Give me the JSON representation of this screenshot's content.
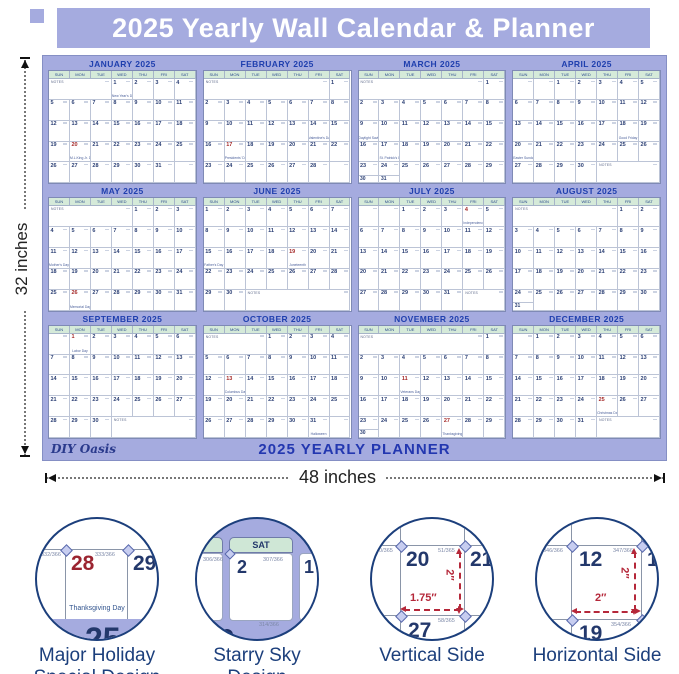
{
  "header": {
    "title": "2025 Yearly Wall Calendar & Planner"
  },
  "dimensions": {
    "height_label": "32 inches",
    "width_label": "48 inches"
  },
  "poster": {
    "brand": "DIY Oasis",
    "footer_title": "2025 YEARLY PLANNER",
    "notes_label": "NOTES",
    "day_headers": [
      "SUN",
      "MON",
      "TUE",
      "WED",
      "THU",
      "FRI",
      "SAT"
    ],
    "months": [
      {
        "title": "JANUARY 2025",
        "first_dow": 3,
        "days": 31,
        "red_days": [
          20
        ],
        "holidays": {
          "1": "New Year's Day",
          "20": "M.L.King Jr. Day"
        },
        "notes": "lead"
      },
      {
        "title": "FEBRUARY 2025",
        "first_dow": 6,
        "days": 28,
        "red_days": [
          17
        ],
        "holidays": {
          "14": "Valentine's Day",
          "17": "Presidents' Day"
        },
        "notes": "lead"
      },
      {
        "title": "MARCH 2025",
        "first_dow": 6,
        "days": 31,
        "red_days": [],
        "holidays": {
          "9": "Daylight Saving",
          "17": "St. Patrick's Day"
        },
        "notes": "lead"
      },
      {
        "title": "APRIL 2025",
        "first_dow": 2,
        "days": 30,
        "red_days": [],
        "holidays": {
          "18": "Good Friday",
          "20": "Easter Sunday"
        },
        "notes": "tail"
      },
      {
        "title": "MAY 2025",
        "first_dow": 4,
        "days": 31,
        "red_days": [
          26
        ],
        "holidays": {
          "11": "Mother's Day",
          "26": "Memorial Day"
        },
        "notes": "lead"
      },
      {
        "title": "JUNE 2025",
        "first_dow": 0,
        "days": 30,
        "red_days": [
          19
        ],
        "holidays": {
          "15": "Father's Day",
          "19": "Juneteenth"
        },
        "notes": "tail"
      },
      {
        "title": "JULY 2025",
        "first_dow": 2,
        "days": 31,
        "red_days": [
          4
        ],
        "holidays": {
          "4": "Independence Day"
        },
        "notes": "tail"
      },
      {
        "title": "AUGUST 2025",
        "first_dow": 5,
        "days": 31,
        "red_days": [],
        "holidays": {},
        "notes": "lead"
      },
      {
        "title": "SEPTEMBER 2025",
        "first_dow": 1,
        "days": 30,
        "red_days": [
          1
        ],
        "holidays": {
          "1": "Labor Day"
        },
        "notes": "tail"
      },
      {
        "title": "OCTOBER 2025",
        "first_dow": 3,
        "days": 31,
        "red_days": [
          13
        ],
        "holidays": {
          "13": "Columbus Day",
          "31": "Halloween"
        },
        "notes": "lead"
      },
      {
        "title": "NOVEMBER 2025",
        "first_dow": 6,
        "days": 30,
        "red_days": [
          11,
          27
        ],
        "holidays": {
          "11": "Veterans Day",
          "27": "Thanksgiving Day"
        },
        "notes": "lead"
      },
      {
        "title": "DECEMBER 2025",
        "first_dow": 1,
        "days": 31,
        "red_days": [
          25
        ],
        "holidays": {
          "25": "Christmas Day"
        },
        "notes": "tail"
      }
    ]
  },
  "features": [
    {
      "label": "Major Holiday Special Design",
      "detail": {
        "day_left": "28",
        "day_right": "29",
        "holiday": "Thanksgiving Day",
        "big_day_partial": "25",
        "doy_left": "332/366",
        "doy_right": "333/366"
      }
    },
    {
      "label": "Starry Sky Design",
      "detail": {
        "header": "SAT",
        "day_main": "2",
        "day_right_partial": "1",
        "doy_left": "306/366",
        "doy_right": "307/366",
        "doy_bottom": "314/366"
      }
    },
    {
      "label": "Vertical Side",
      "detail": {
        "day_tl": "20",
        "day_tr": "21",
        "day_bl": "27",
        "doy_left": "50/365",
        "doy_mid": "51/365",
        "doy_bottom": "58/365",
        "dim_width": "1.75″",
        "dim_height": "2″"
      }
    },
    {
      "label": "Horizontal Side",
      "detail": {
        "day_tl": "12",
        "day_tr": "13",
        "day_bl": "19",
        "doy_left": "346/366",
        "doy_mid": "347/366",
        "doy_bottom": "354/366",
        "dim_width": "2″",
        "dim_height": "2″"
      }
    }
  ],
  "colors": {
    "lavender": "#a5abdf",
    "mint": "#d5ead9",
    "title_blue": "#1f3fae",
    "date_navy": "#2b3f74",
    "holiday_red": "#a52a2a",
    "footer_blue": "#2337b0",
    "circle_navy": "#1c3f7c",
    "dim_red": "#b5283a"
  }
}
